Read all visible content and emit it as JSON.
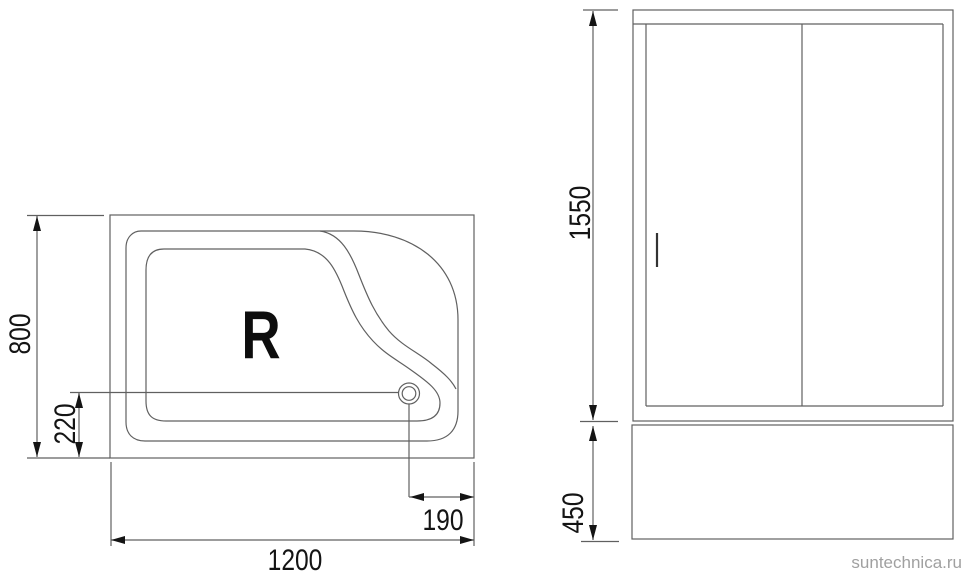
{
  "watermark": {
    "text": "suntechnica.ru",
    "color": "#a0a0a0"
  },
  "drawing": {
    "line_color": "#606060",
    "text_color": "#141414",
    "top_view": {
      "orientation_label": "R",
      "dim_width": "1200",
      "dim_depth": "800",
      "dim_drain_from_bottom": "220",
      "dim_drain_from_right": "190"
    },
    "side_view": {
      "dim_door_height": "1550",
      "dim_tray_height": "450"
    }
  }
}
